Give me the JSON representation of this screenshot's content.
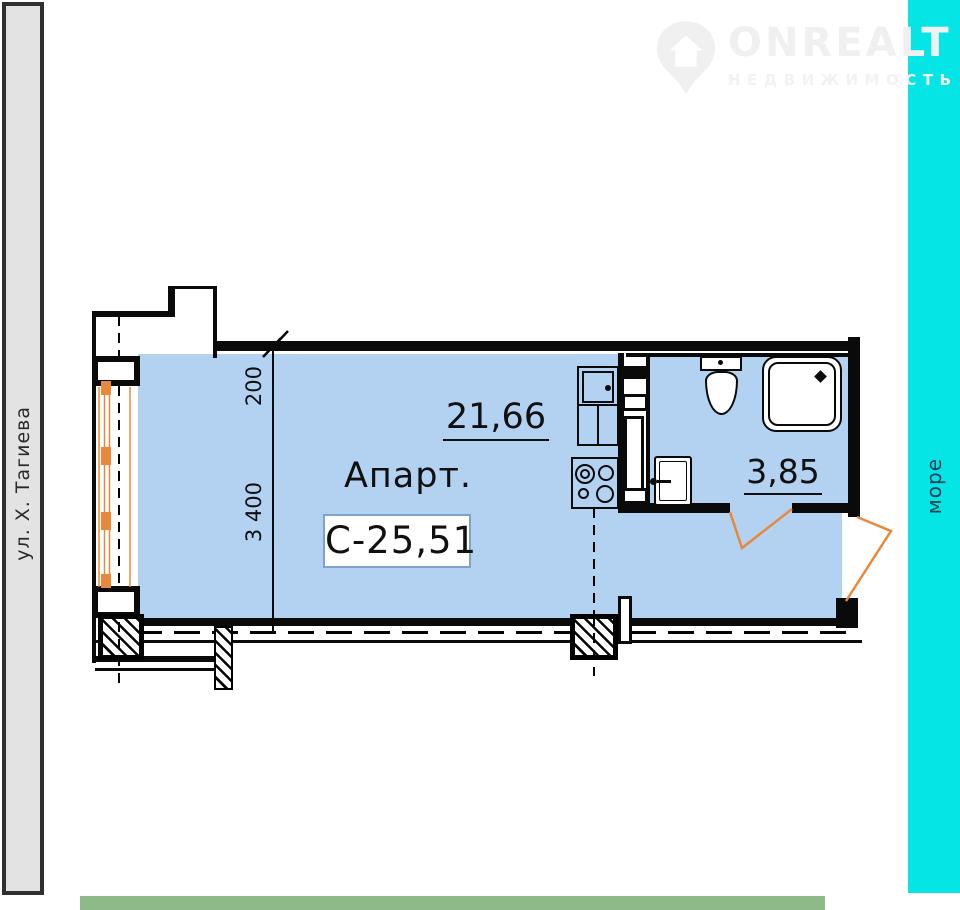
{
  "left_strip": {
    "label": "ул. Х. Тагиева"
  },
  "right_strip": {
    "label": "море"
  },
  "watermark": {
    "brand": "ONREALT",
    "subtitle": "НЕДВИЖИМОСТЬ"
  },
  "plan": {
    "apartment_label": "Апарт.",
    "unit_number": "С-25,51",
    "living_area": "21,66",
    "bathroom_area": "3,85",
    "dimensions": {
      "balcony_offset": "200",
      "room_width": "3 400"
    }
  },
  "colors": {
    "plan_fill": "#b3d2f2",
    "accent_orange": "#e8883c",
    "sea_cyan": "#06e5e5",
    "sea_text": "#1b4152",
    "bottom_green": "#8eba8a",
    "strip_gray": "#e3e3e3",
    "line_black": "#0a0a0a",
    "unit_box_border": "#7da3cc",
    "watermark_gray": "#f0f0f0"
  }
}
